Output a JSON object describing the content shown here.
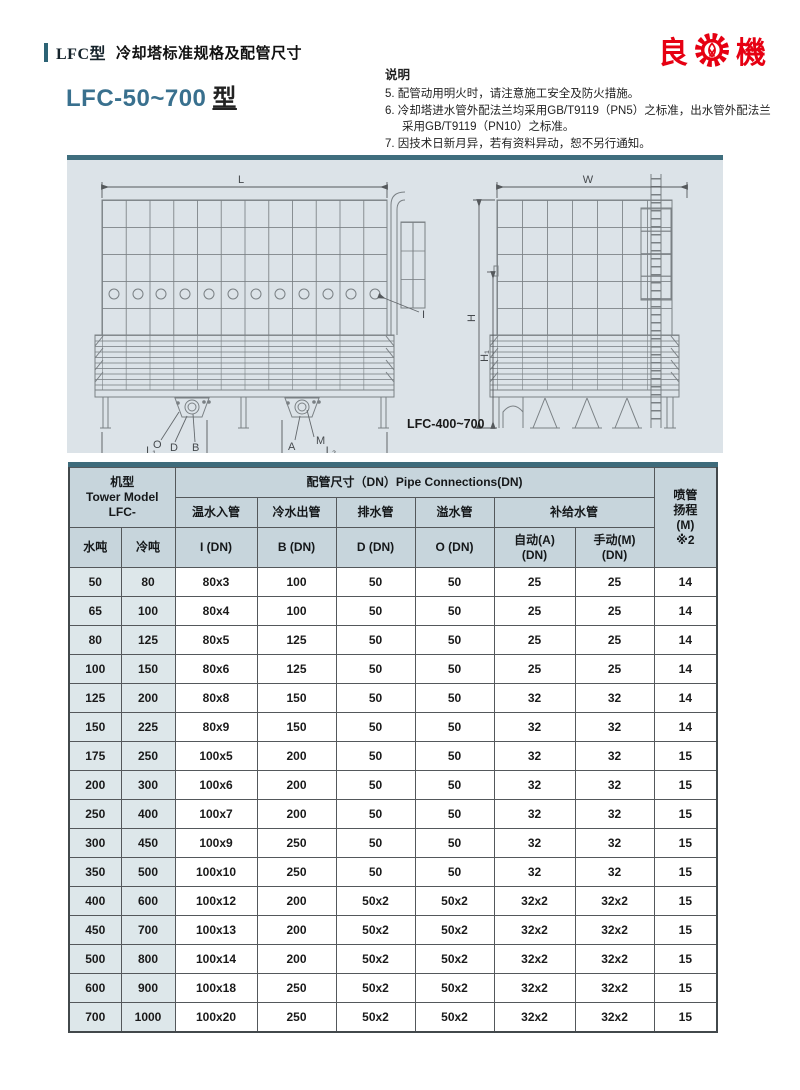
{
  "header": {
    "series_label": "LFC型",
    "title": "冷却塔标准规格及配管尺寸"
  },
  "logo": {
    "left_char": "良",
    "right_char": "機",
    "brand_color": "#e60012"
  },
  "model_heading": {
    "range": "LFC-50~700",
    "suffix": "型"
  },
  "notes": {
    "title": "说明",
    "items": [
      "5. 配管动用明火时，请注意施工安全及防火措施。",
      "6. 冷却塔进水管外配法兰均采用GB/T9119（PN5）之标准，出水管外配法兰采用GB/T9119（PN10）之标准。",
      "7. 因技术日新月异，若有资料异动，恕不另行通知。"
    ]
  },
  "diagram": {
    "caption": "LFC-400~700",
    "labels": {
      "l": "L",
      "w": "W",
      "h": "H",
      "h1": "H₁",
      "l1": "L₁",
      "l2": "L₂",
      "i": "I",
      "o": "O",
      "d": "D",
      "b": "B",
      "a": "A",
      "m": "M"
    }
  },
  "table": {
    "header": {
      "model_group": {
        "line1": "机型",
        "line2": "Tower Model",
        "line3": "LFC-"
      },
      "pipe_group": "配管尺寸（DN）Pipe Connections(DN)",
      "sub_warm": "温水入管",
      "sub_cold": "冷水出管",
      "sub_drain": "排水管",
      "sub_overflow": "溢水管",
      "sub_makeup": "补给水管",
      "col_water_ton": "水吨",
      "col_cool_ton": "冷吨",
      "col_i": "I (DN)",
      "col_b": "B (DN)",
      "col_d": "D (DN)",
      "col_o": "O (DN)",
      "col_auto_l1": "自动(A)",
      "col_auto_l2": "(DN)",
      "col_manual_l1": "手动(M)",
      "col_manual_l2": "(DN)",
      "spray_l1": "喷管",
      "spray_l2": "扬程",
      "spray_l3": "(M)",
      "spray_l4": "※2"
    },
    "rows": [
      [
        "50",
        "80",
        "80x3",
        "100",
        "50",
        "50",
        "25",
        "25",
        "14"
      ],
      [
        "65",
        "100",
        "80x4",
        "100",
        "50",
        "50",
        "25",
        "25",
        "14"
      ],
      [
        "80",
        "125",
        "80x5",
        "125",
        "50",
        "50",
        "25",
        "25",
        "14"
      ],
      [
        "100",
        "150",
        "80x6",
        "125",
        "50",
        "50",
        "25",
        "25",
        "14"
      ],
      [
        "125",
        "200",
        "80x8",
        "150",
        "50",
        "50",
        "32",
        "32",
        "14"
      ],
      [
        "150",
        "225",
        "80x9",
        "150",
        "50",
        "50",
        "32",
        "32",
        "14"
      ],
      [
        "175",
        "250",
        "100x5",
        "200",
        "50",
        "50",
        "32",
        "32",
        "15"
      ],
      [
        "200",
        "300",
        "100x6",
        "200",
        "50",
        "50",
        "32",
        "32",
        "15"
      ],
      [
        "250",
        "400",
        "100x7",
        "200",
        "50",
        "50",
        "32",
        "32",
        "15"
      ],
      [
        "300",
        "450",
        "100x9",
        "250",
        "50",
        "50",
        "32",
        "32",
        "15"
      ],
      [
        "350",
        "500",
        "100x10",
        "250",
        "50",
        "50",
        "32",
        "32",
        "15"
      ],
      [
        "400",
        "600",
        "100x12",
        "200",
        "50x2",
        "50x2",
        "32x2",
        "32x2",
        "15"
      ],
      [
        "450",
        "700",
        "100x13",
        "200",
        "50x2",
        "50x2",
        "32x2",
        "32x2",
        "15"
      ],
      [
        "500",
        "800",
        "100x14",
        "200",
        "50x2",
        "50x2",
        "32x2",
        "32x2",
        "15"
      ],
      [
        "600",
        "900",
        "100x18",
        "250",
        "50x2",
        "50x2",
        "32x2",
        "32x2",
        "15"
      ],
      [
        "700",
        "1000",
        "100x20",
        "250",
        "50x2",
        "50x2",
        "32x2",
        "32x2",
        "15"
      ]
    ]
  }
}
